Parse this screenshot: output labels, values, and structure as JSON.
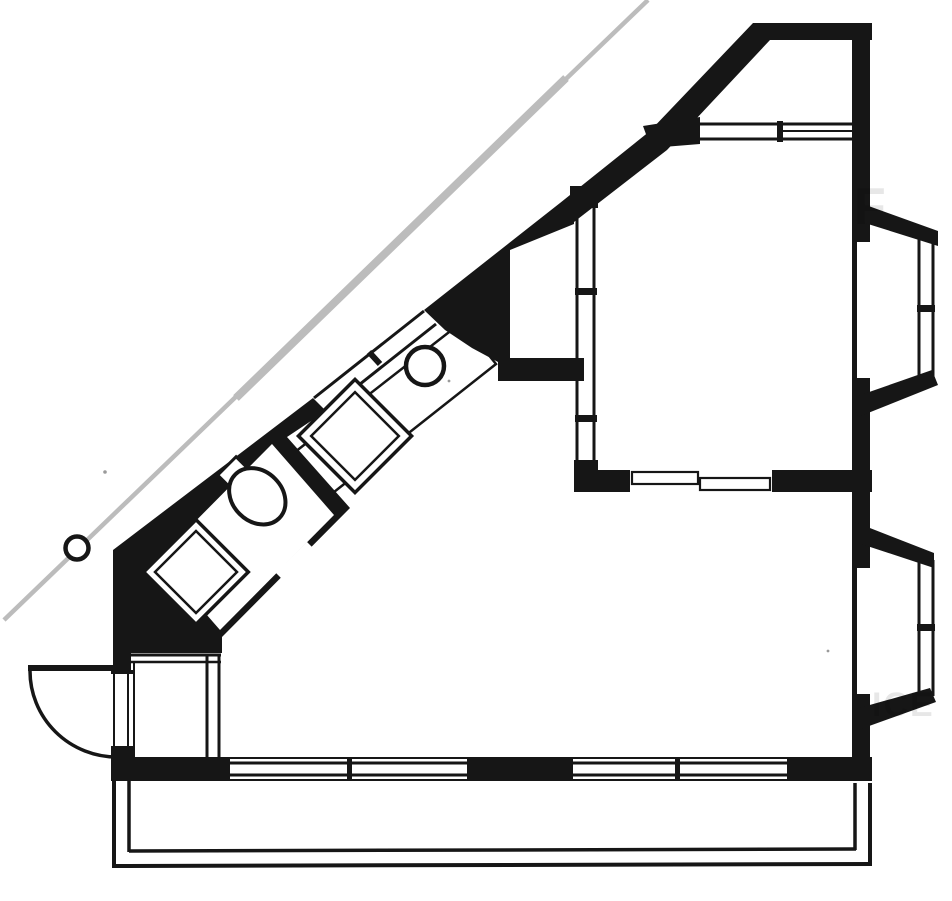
{
  "artwork": {
    "kind": "scanned architectural floor plan",
    "style": "black-ink line drawing on white paper, no text labels",
    "colors": {
      "ink": "#161616",
      "paper": "#ffffff",
      "property_line": "#bcbcbc"
    }
  },
  "elements": {
    "property_line": "gray diagonal site boundary line, upper-left",
    "survey_marker": "small outlined circle on the boundary line",
    "entry_door": "exterior door leaf with quarter-circle swing arc, lower-left",
    "vestibule": "small entry closet with thin double-line partitions",
    "bathroom": {
      "orientation": "rotated 45 degrees along diagonal wall",
      "fixtures": [
        "toilet",
        "washbasin"
      ],
      "door": "opening in lower diagonal wall"
    },
    "kitchen": {
      "fixtures": [
        "counter-strip",
        "sink-square",
        "cooktop-circle"
      ],
      "window": "double-line window in diagonal facade"
    },
    "loggia": "white recess behind upper diagonal wall",
    "bedroom": {
      "top_window": "horizontal double-line band with mullion",
      "side_window": "vertical double-line band with two mullions",
      "sliding_door": "two offset panes in partition wall"
    },
    "bay_windows": 2,
    "facade_windows_bottom": 4,
    "balcony": "thin double-line parapet across the bottom"
  },
  "watermark": {
    "fragments": [
      {
        "text": "F",
        "x": "854",
        "y": "224",
        "size": "52"
      },
      {
        "text": "ICE",
        "x": "872",
        "y": "716",
        "size": "34"
      }
    ]
  }
}
